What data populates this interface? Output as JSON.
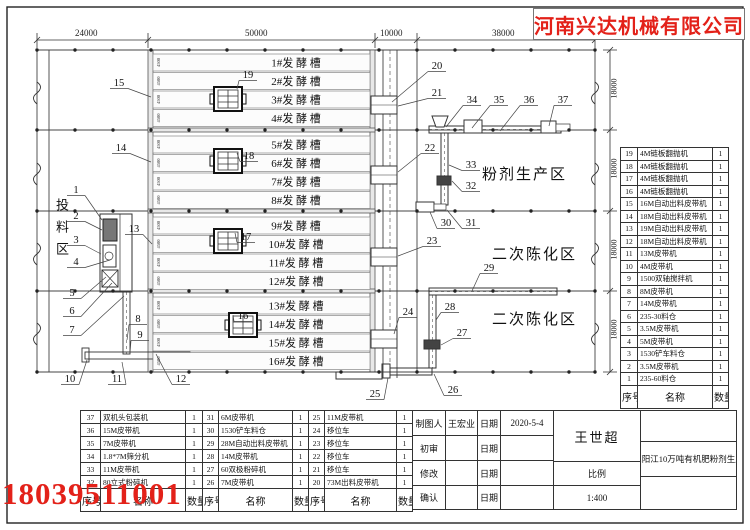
{
  "company": "河南兴达机械有限公司",
  "phone": "18039511001",
  "dims": {
    "top": [
      "24000",
      "50000",
      "10000",
      "38000"
    ],
    "right": [
      "18000",
      "18000",
      "18000",
      "18000"
    ],
    "trough_side": "4500"
  },
  "areas": {
    "feed": "投料区",
    "powder": "粉剂生产区",
    "aging": "二次陈化区"
  },
  "troughs": [
    "1#发 酵 槽",
    "2#发 酵 槽",
    "3#发 酵 槽",
    "4#发 酵 槽",
    "5#发 酵 槽",
    "6#发 酵 槽",
    "7#发 酵 槽",
    "8#发 酵 槽",
    "9#发 酵 槽",
    "10#发 酵 槽",
    "11#发 酵 槽",
    "12#发 酵 槽",
    "13#发 酵 槽",
    "14#发 酵 槽",
    "15#发 酵 槽",
    "16#发 酵 槽"
  ],
  "callouts": [
    {
      "n": "1",
      "x": 76,
      "y": 193,
      "tx": 102,
      "ty": 220
    },
    {
      "n": "2",
      "x": 76,
      "y": 219,
      "tx": 102,
      "ty": 230
    },
    {
      "n": "3",
      "x": 76,
      "y": 243,
      "tx": 101,
      "ty": 254
    },
    {
      "n": "4",
      "x": 76,
      "y": 265,
      "tx": 110,
      "ty": 260
    },
    {
      "n": "5",
      "x": 72,
      "y": 296,
      "tx": 106,
      "ty": 277
    },
    {
      "n": "6",
      "x": 72,
      "y": 314,
      "tx": 112,
      "ty": 283
    },
    {
      "n": "7",
      "x": 72,
      "y": 333,
      "tx": 124,
      "ty": 296
    },
    {
      "n": "8",
      "x": 138,
      "y": 322,
      "tx": 127,
      "ty": 340
    },
    {
      "n": "9",
      "x": 140,
      "y": 338,
      "tx": 130,
      "ty": 353
    },
    {
      "n": "10",
      "x": 70,
      "y": 382,
      "tx": 87,
      "ty": 360
    },
    {
      "n": "11",
      "x": 117,
      "y": 382,
      "tx": 122,
      "ty": 362
    },
    {
      "n": "12",
      "x": 181,
      "y": 382,
      "tx": 156,
      "ty": 354
    },
    {
      "n": "13",
      "x": 134,
      "y": 232,
      "tx": 152,
      "ty": 244
    },
    {
      "n": "14",
      "x": 121,
      "y": 151,
      "tx": 151,
      "ty": 162
    },
    {
      "n": "15",
      "x": 119,
      "y": 86,
      "tx": 151,
      "ty": 97
    },
    {
      "n": "16",
      "x": 243,
      "y": 319,
      "tx": 233,
      "ty": 315
    },
    {
      "n": "17",
      "x": 246,
      "y": 240,
      "tx": 235,
      "ty": 233
    },
    {
      "n": "18",
      "x": 249,
      "y": 159,
      "tx": 237,
      "ty": 153
    },
    {
      "n": "19",
      "x": 248,
      "y": 78,
      "tx": 237,
      "ty": 89
    },
    {
      "n": "20",
      "x": 437,
      "y": 69,
      "tx": 392,
      "ty": 102
    },
    {
      "n": "21",
      "x": 437,
      "y": 96,
      "tx": 398,
      "ty": 106
    },
    {
      "n": "22",
      "x": 430,
      "y": 151,
      "tx": 398,
      "ty": 172
    },
    {
      "n": "23",
      "x": 432,
      "y": 244,
      "tx": 398,
      "ty": 256
    },
    {
      "n": "24",
      "x": 408,
      "y": 315,
      "tx": 394,
      "ty": 334
    },
    {
      "n": "25",
      "x": 375,
      "y": 397,
      "tx": 388,
      "ty": 378
    },
    {
      "n": "26",
      "x": 453,
      "y": 393,
      "tx": 434,
      "ty": 374
    },
    {
      "n": "27",
      "x": 462,
      "y": 336,
      "tx": 441,
      "ty": 345
    },
    {
      "n": "28",
      "x": 450,
      "y": 310,
      "tx": 436,
      "ty": 320
    },
    {
      "n": "29",
      "x": 489,
      "y": 271,
      "tx": 472,
      "ty": 291
    },
    {
      "n": "30",
      "x": 446,
      "y": 226,
      "tx": 430,
      "ty": 212
    },
    {
      "n": "31",
      "x": 471,
      "y": 226,
      "tx": 447,
      "ty": 210
    },
    {
      "n": "32",
      "x": 471,
      "y": 189,
      "tx": 452,
      "ty": 181
    },
    {
      "n": "33",
      "x": 471,
      "y": 168,
      "tx": 449,
      "ty": 165
    },
    {
      "n": "34",
      "x": 472,
      "y": 103,
      "tx": 446,
      "ty": 127
    },
    {
      "n": "35",
      "x": 499,
      "y": 103,
      "tx": 472,
      "ty": 128
    },
    {
      "n": "36",
      "x": 529,
      "y": 103,
      "tx": 500,
      "ty": 131
    },
    {
      "n": "37",
      "x": 563,
      "y": 103,
      "tx": 549,
      "ty": 126
    }
  ],
  "right_table": {
    "headers": [
      "序号",
      "名称",
      "数量"
    ],
    "rows": [
      [
        "19",
        "4M链板翻抛机",
        "1"
      ],
      [
        "18",
        "4M链板翻抛机",
        "1"
      ],
      [
        "17",
        "4M链板翻抛机",
        "1"
      ],
      [
        "16",
        "4M链板翻抛机",
        "1"
      ],
      [
        "15",
        "16M自动出料皮带机",
        "1"
      ],
      [
        "14",
        "18M自动出料皮带机",
        "1"
      ],
      [
        "13",
        "19M自动出料皮带机",
        "1"
      ],
      [
        "12",
        "18M自动出料皮带机",
        "1"
      ],
      [
        "11",
        "13M皮带机",
        "1"
      ],
      [
        "10",
        "4M皮带机",
        "1"
      ],
      [
        "9",
        "1500双轴搅拌机",
        "1"
      ],
      [
        "8",
        "8M皮带机",
        "1"
      ],
      [
        "7",
        "14M皮带机",
        "1"
      ],
      [
        "6",
        "235-30料仓",
        "1"
      ],
      [
        "5",
        "3.5M皮带机",
        "1"
      ],
      [
        "4",
        "5M皮带机",
        "1"
      ],
      [
        "3",
        "1530铲车料仓",
        "1"
      ],
      [
        "2",
        "3.5M皮带机",
        "1"
      ],
      [
        "1",
        "235-60料仓",
        "1"
      ]
    ]
  },
  "bottom_table": {
    "headers": [
      "序号",
      "名称",
      "数量"
    ],
    "group_a": [
      [
        "37",
        "双机头包装机",
        "1"
      ],
      [
        "36",
        "15M皮带机",
        "1"
      ],
      [
        "35",
        "7M皮带机",
        "1"
      ],
      [
        "34",
        "1.8*7M筛分机",
        "1"
      ],
      [
        "33",
        "11M皮带机",
        "1"
      ],
      [
        "32",
        "80立式粉碎机",
        "1"
      ]
    ],
    "group_b": [
      [
        "31",
        "6M皮带机",
        "1"
      ],
      [
        "30",
        "1530铲车料仓",
        "1"
      ],
      [
        "29",
        "28M自动出料皮带机",
        "1"
      ],
      [
        "28",
        "14M皮带机",
        "1"
      ],
      [
        "27",
        "60双极粉碎机",
        "1"
      ],
      [
        "26",
        "7M皮带机",
        "1"
      ]
    ],
    "group_c": [
      [
        "25",
        "11M皮带机",
        "1"
      ],
      [
        "24",
        "移位车",
        "1"
      ],
      [
        "23",
        "移位车",
        "1"
      ],
      [
        "22",
        "移位车",
        "1"
      ],
      [
        "21",
        "移位车",
        "1"
      ],
      [
        "20",
        "73M出料皮带机",
        "1"
      ]
    ]
  },
  "title_block": {
    "row1_label": "制图人",
    "row1_value": "王宏业",
    "date_label": "日期",
    "row1_date": "2020-5-4",
    "row2_label": "初审",
    "row2_value": "",
    "row2_date": "",
    "row3_label": "修改",
    "row3_value": "",
    "row3_date": "",
    "row4_label": "确认",
    "row4_value": "",
    "row4_date": "",
    "approver": "王世超",
    "scale_label": "比例",
    "scale_value": "1:400",
    "project": "广东阳江10万吨有机肥粉剂生产线"
  }
}
